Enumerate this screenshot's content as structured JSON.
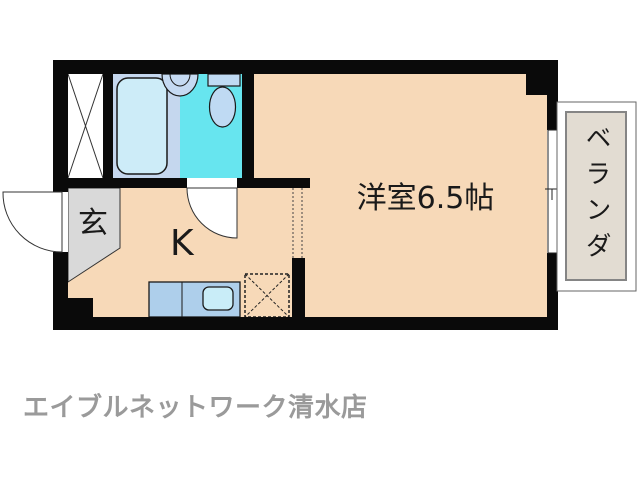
{
  "floor_plan": {
    "main_room_label": "洋室6.5帖",
    "kitchen_label": "K",
    "entrance_label": "玄",
    "veranda_label": "ベランダ",
    "fixtures": [
      "pipe-space-x-box",
      "bathtub",
      "wash-basin",
      "toilet",
      "entrance-swing-door",
      "bathroom-swing-door",
      "kitchen-counter",
      "kitchen-sink",
      "refrigerator-space-dashed",
      "sliding-window"
    ],
    "colors": {
      "wall": "#0a0a0a",
      "floor": "#f7d9b8",
      "entrance_floor": "#d9d9d9",
      "bathroom_floor": "#c5d7ee",
      "shower_room_floor": "#67e5ef",
      "bathtub": "#cdecf8",
      "fixture_blue": "#bfdaf3",
      "kitchen_counter": "#aecfeb",
      "kitchen_sink": "#c9edf8",
      "veranda_floor": "#e2dcd2"
    }
  },
  "footer": {
    "agency_name": "エイブルネットワーク清水店"
  }
}
